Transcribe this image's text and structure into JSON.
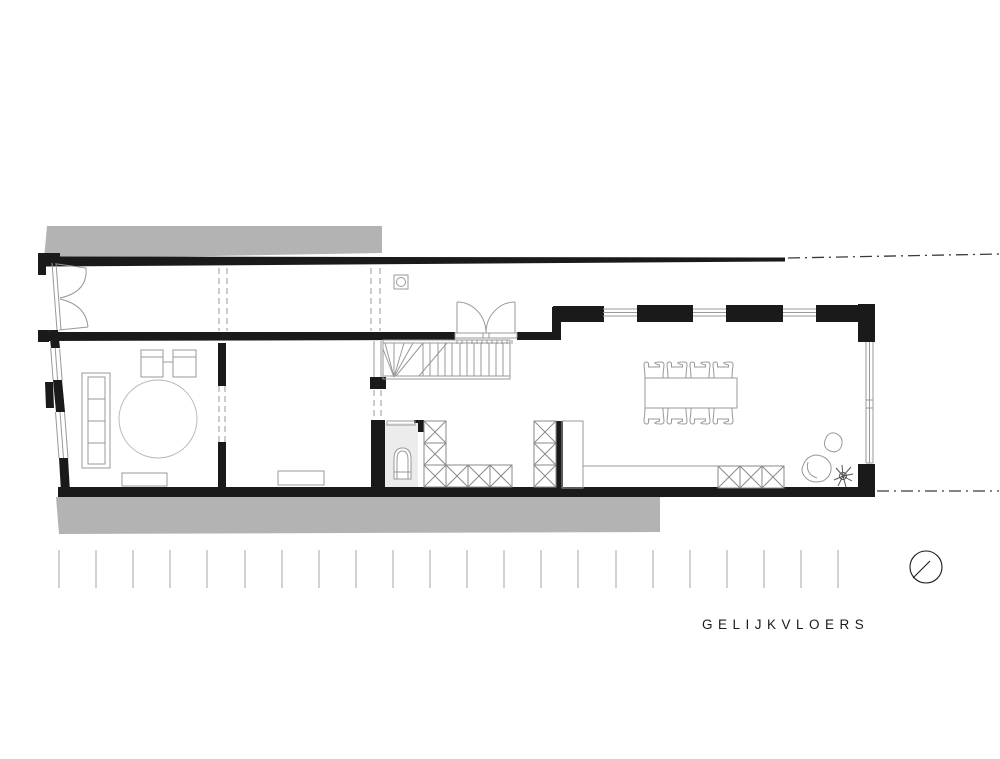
{
  "title": {
    "label": "GELIJKVLOERS"
  },
  "colors": {
    "wall": "#1a1a1a",
    "line": "#999999",
    "xline": "#8a8a8a",
    "soft": "#bbbbbb",
    "neighbor": "#b3b3b3",
    "toilet": "#ececec",
    "dashdot": "#3a3a3a",
    "tick": "#a6a6a6",
    "text": "#1a1a1a"
  },
  "symbols": {
    "north_indicator": "circle with needle",
    "column": "square with inscribed circle",
    "cabinet_marker": "crossed box"
  }
}
